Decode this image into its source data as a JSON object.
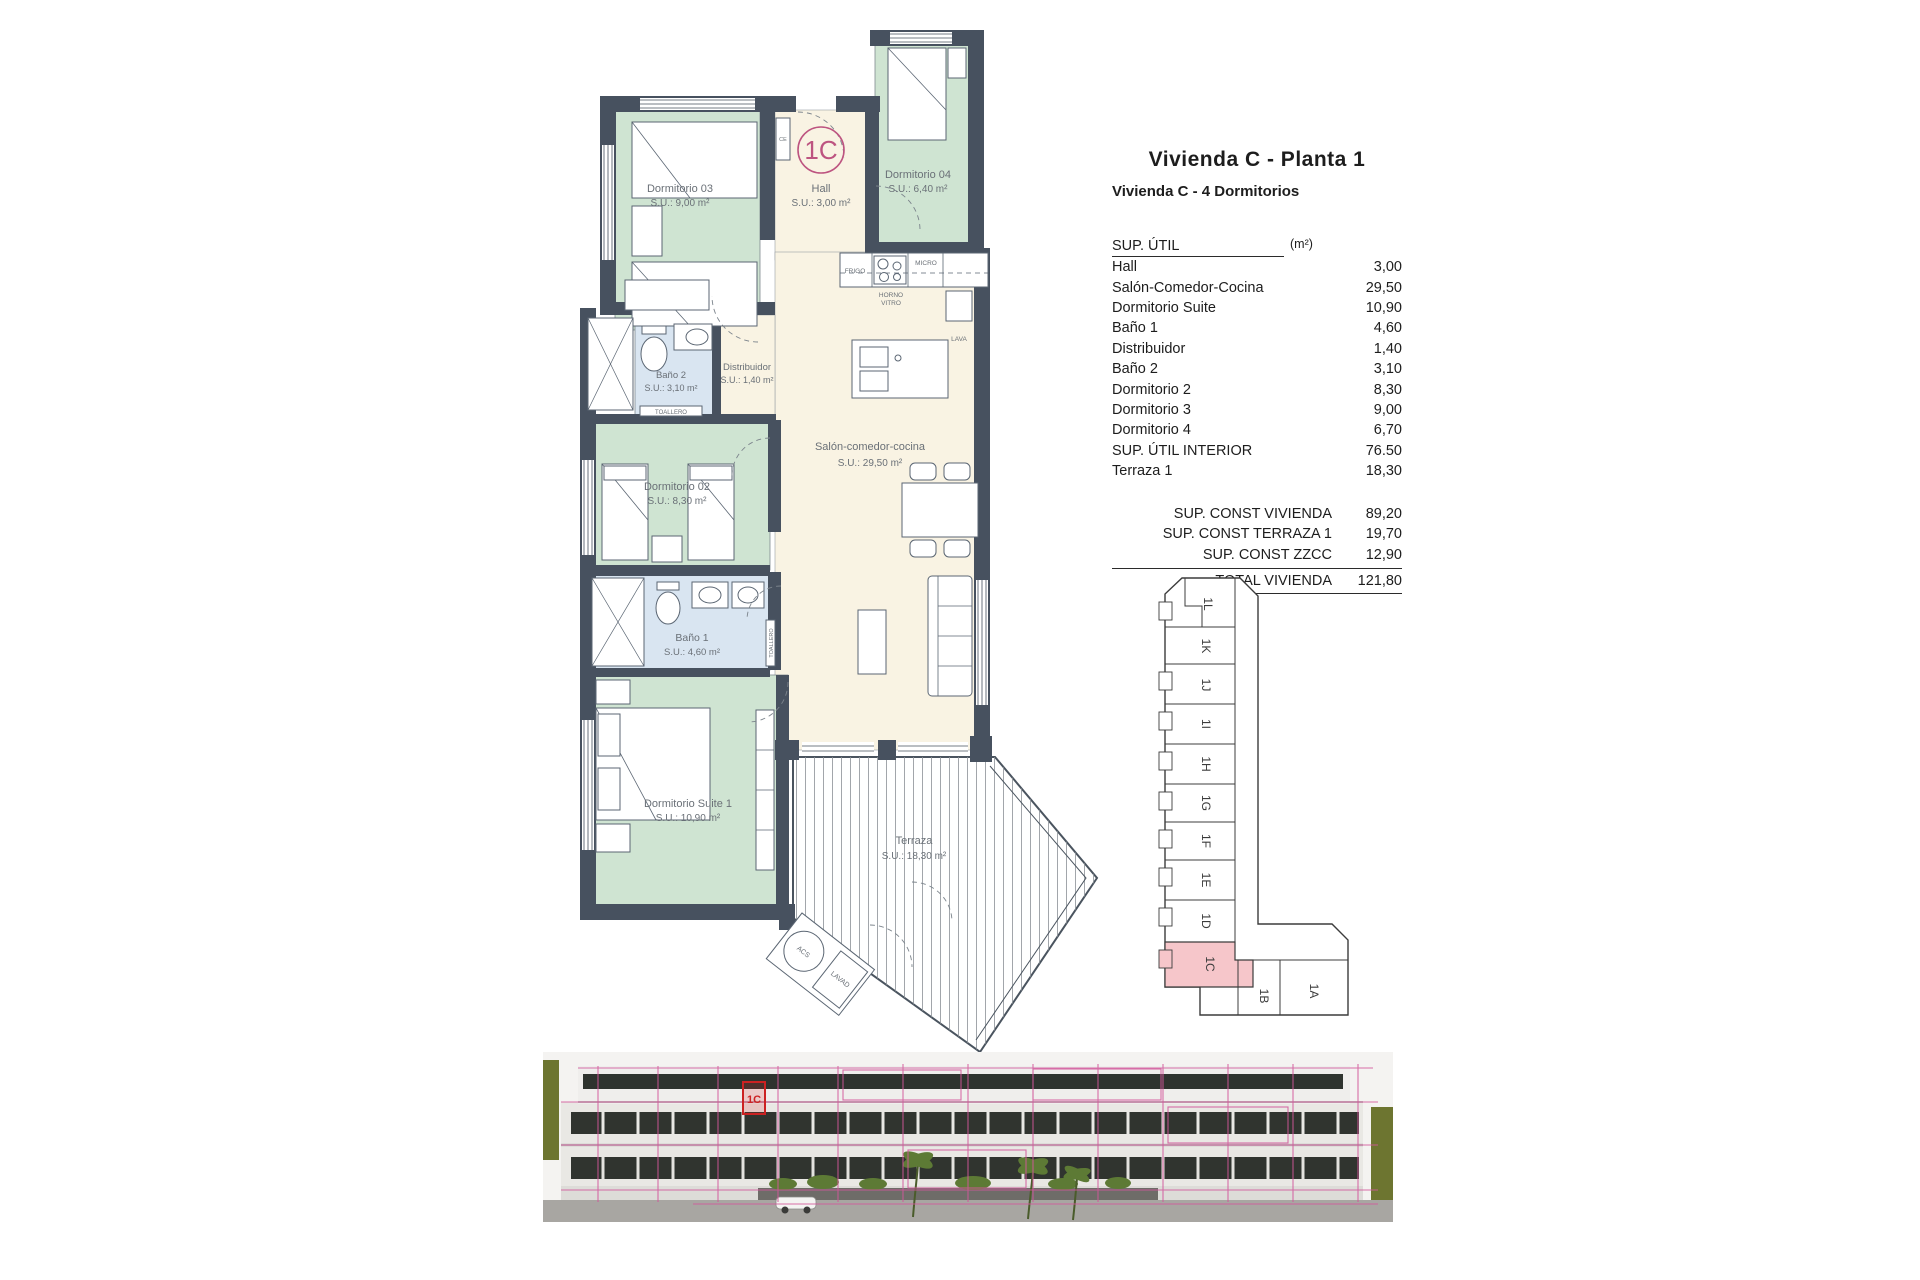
{
  "header": {
    "title": "Vivienda C - Planta 1",
    "subtitle": "Vivienda C - 4 Dormitorios"
  },
  "table": {
    "col_label": "SUP. ÚTIL",
    "col_unit": "(m²)",
    "rows": [
      {
        "label": "Hall",
        "value": "3,00"
      },
      {
        "label": "Salón-Comedor-Cocina",
        "value": "29,50"
      },
      {
        "label": "Dormitorio Suite",
        "value": "10,90"
      },
      {
        "label": "Baño 1",
        "value": "4,60"
      },
      {
        "label": "Distribuidor",
        "value": "1,40"
      },
      {
        "label": "Baño 2",
        "value": "3,10"
      },
      {
        "label": "Dormitorio 2",
        "value": "8,30"
      },
      {
        "label": "Dormitorio 3",
        "value": "9,00"
      },
      {
        "label": "Dormitorio 4",
        "value": "6,70"
      },
      {
        "label": "SUP. ÚTIL INTERIOR",
        "value": "76.50"
      },
      {
        "label": "Terraza 1",
        "value": "18,30"
      }
    ],
    "summary": [
      {
        "label": "SUP. CONST VIVIENDA",
        "value": "89,20"
      },
      {
        "label": "SUP. CONST TERRAZA 1",
        "value": "19,70"
      },
      {
        "label": "SUP. CONST ZZCC",
        "value": "12,90"
      }
    ],
    "total": {
      "label": "TOTAL VIVIENDA",
      "value": "121,80"
    }
  },
  "plan": {
    "unit": "1C",
    "rooms": {
      "d03": {
        "name": "Dormitorio 03",
        "area": "S.U.: 9,00 m²"
      },
      "hall": {
        "name": "Hall",
        "area": "S.U.: 3,00 m²"
      },
      "d04": {
        "name": "Dormitorio 04",
        "area": "S.U.: 6,40 m²"
      },
      "salon": {
        "name": "Salón-comedor-cocina",
        "area": "S.U.: 29,50 m²"
      },
      "bano2": {
        "name": "Baño 2",
        "area": "S.U.: 3,10 m²"
      },
      "distribuidor": {
        "name": "Distribuidor",
        "area": "S.U.: 1,40 m²"
      },
      "d02": {
        "name": "Dormitorio 02",
        "area": "S.U.: 8,30 m²"
      },
      "bano1": {
        "name": "Baño 1",
        "area": "S.U.: 4,60 m²"
      },
      "suite": {
        "name": "Dormitorio Suite 1",
        "area": "S.U.: 10,90 m²"
      },
      "terraza": {
        "name": "Terraza",
        "area": "S.U.: 18,30 m²"
      }
    },
    "fixtures": {
      "frigo": "FRIGO",
      "micro": "MICRO",
      "horno1": "HORNO",
      "horno2": "VITRO",
      "lava": "LAVA",
      "toallero": "TOALLERO",
      "ce": "CE",
      "acs": "ACS",
      "lavad": "LAVAD"
    }
  },
  "keyplan": {
    "highlighted": "1C",
    "units": [
      "1L",
      "1K",
      "1J",
      "1I",
      "1H",
      "1G",
      "1F",
      "1E",
      "1D",
      "1C",
      "1B",
      "1A"
    ]
  },
  "photo": {
    "unit_label": "1C"
  },
  "colors": {
    "room_green": "#cfe4d2",
    "room_cream": "#f9f3e3",
    "room_blue": "#d9e5f1",
    "wall": "#47515f",
    "accent_pink": "#b74e7f",
    "keyplan_highlight": "#f6c6ca",
    "overlay_pink": "#d2579b",
    "highlight_red": "#cc2222"
  }
}
